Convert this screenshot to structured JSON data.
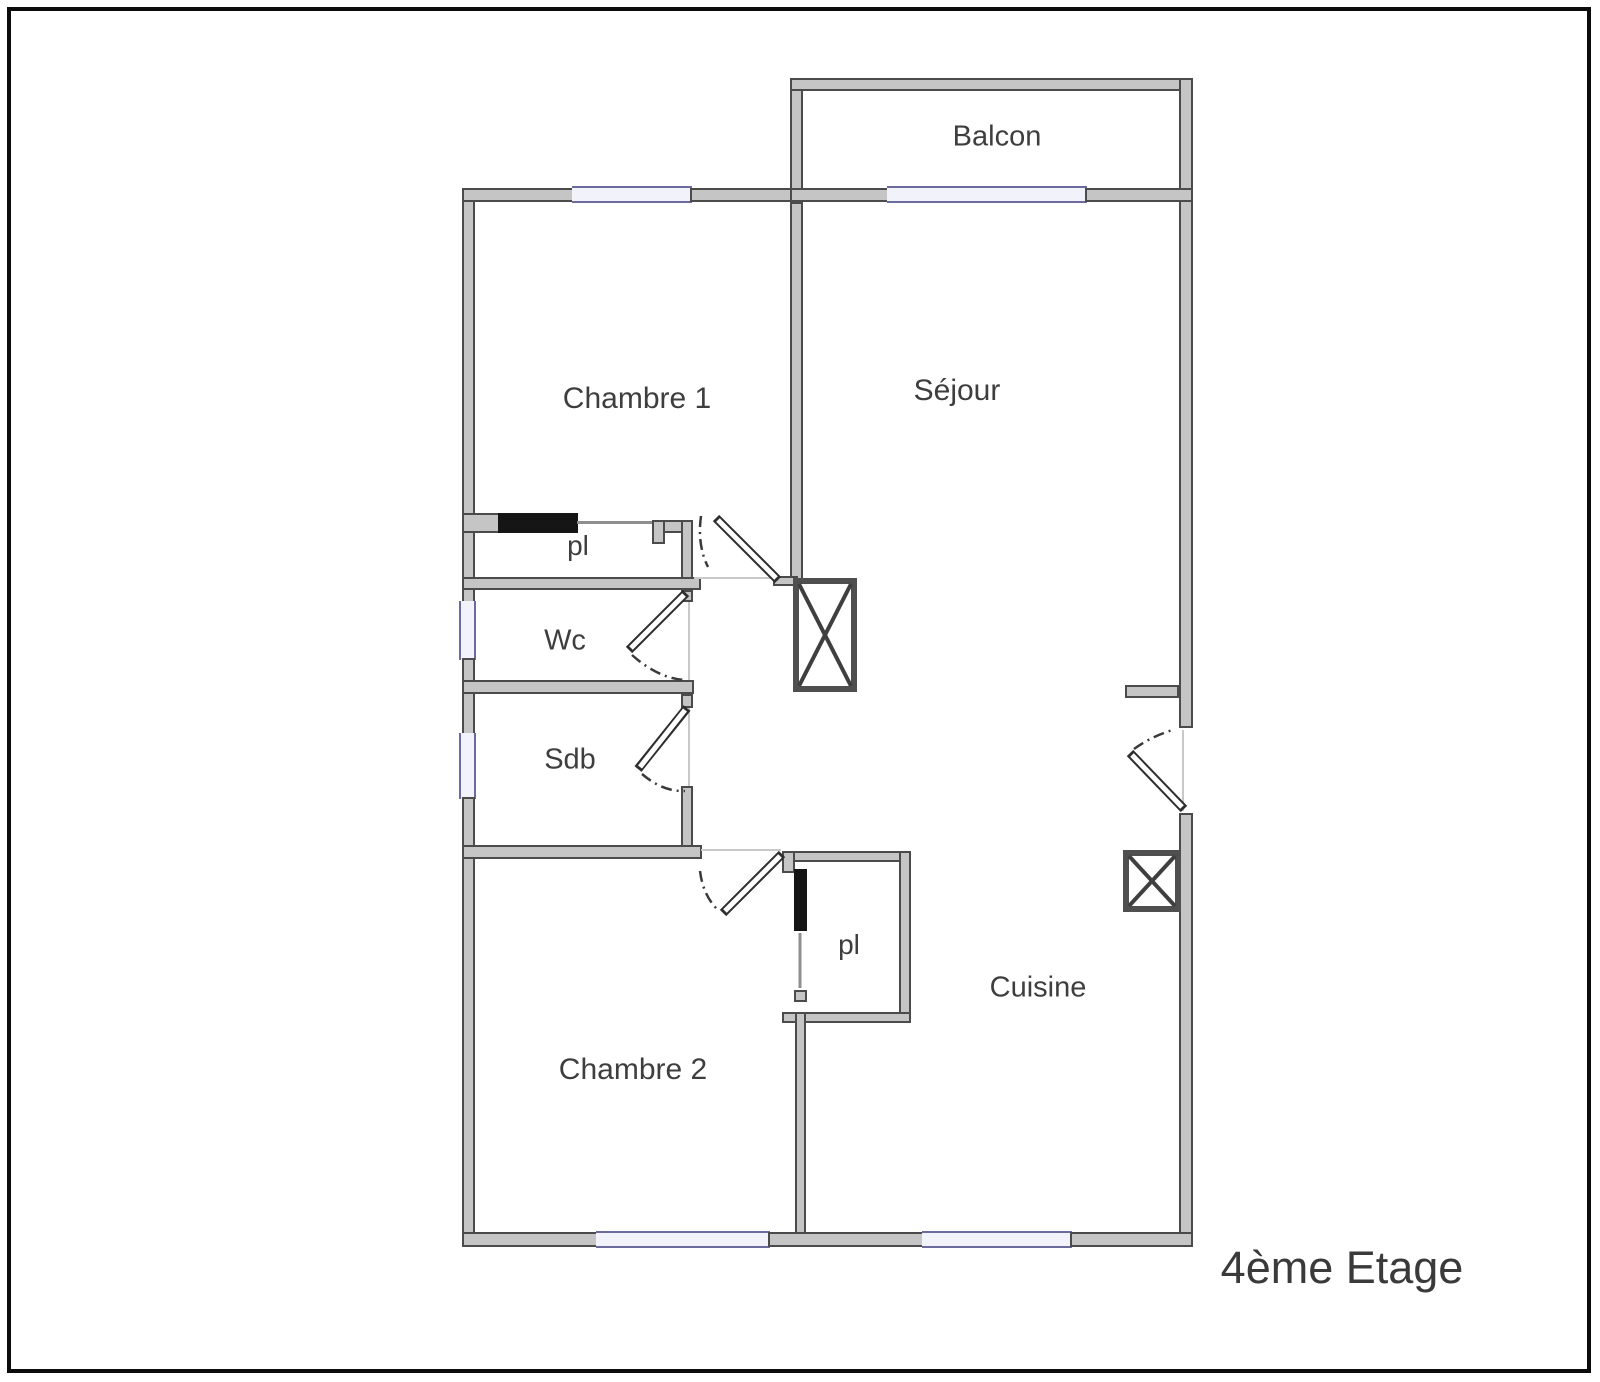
{
  "floor_plan": {
    "title": "4ème Etage",
    "rooms": [
      {
        "name": "balcon",
        "label": "Balcon"
      },
      {
        "name": "chambre-1",
        "label": "Chambre 1"
      },
      {
        "name": "sejour",
        "label": "Séjour"
      },
      {
        "name": "placard-haut",
        "label": "pl"
      },
      {
        "name": "wc",
        "label": "Wc"
      },
      {
        "name": "salle-de-bain",
        "label": "Sdb"
      },
      {
        "name": "chambre-2",
        "label": "Chambre 2"
      },
      {
        "name": "placard-bas",
        "label": "pl"
      },
      {
        "name": "cuisine",
        "label": "Cuisine"
      }
    ],
    "symbols": {
      "window_icon": "blue-double-line",
      "door_icon": "swing-leaf-with-dash-dot-arc",
      "sliding_door_icon": "solid-black-bar",
      "duct_shaft_icon": "crossed-box"
    },
    "colors": {
      "wall_fill": "#c5c5c5",
      "wall_edge": "#4b4b4b",
      "window_line": "#6b6b9e",
      "window_fill": "#f2f2fa",
      "sliding_door": "#151515",
      "text": "#3e3e3e",
      "page_border": "#0c0c0c",
      "background": "#ffffff"
    }
  }
}
